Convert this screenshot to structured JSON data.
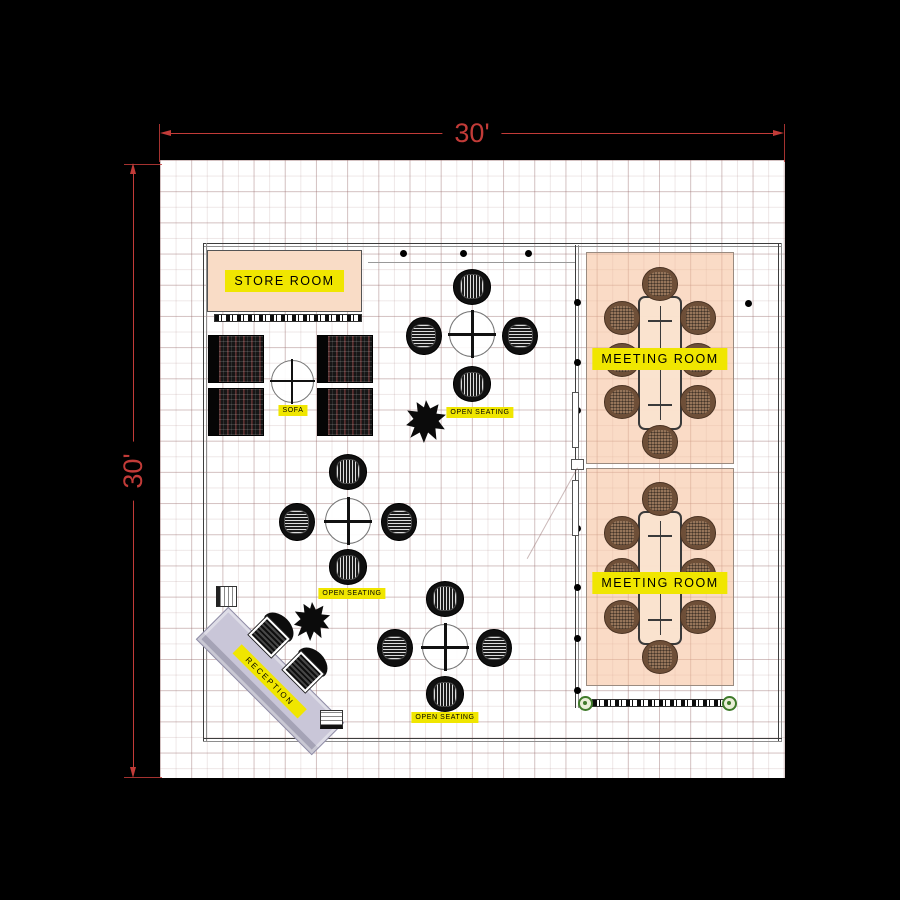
{
  "scene": {
    "type": "office floor plan",
    "background": "#000000"
  },
  "dimensions": {
    "top": {
      "label": "30'"
    },
    "left": {
      "label": "30'"
    }
  },
  "rooms": {
    "store_room": {
      "label": "STORE ROOM"
    },
    "meeting_room_1": {
      "label": "MEETING ROOM"
    },
    "meeting_room_2": {
      "label": "MEETING ROOM"
    }
  },
  "areas": {
    "sofa": {
      "label": "SOFA"
    },
    "open_seating_1": {
      "label": "OPEN SEATING"
    },
    "open_seating_2": {
      "label": "OPEN SEATING"
    },
    "open_seating_3": {
      "label": "OPEN SEATING"
    },
    "reception": {
      "label": "RECEPTION"
    }
  },
  "colors": {
    "dimension_red": "#c23b38",
    "label_yellow": "#f0e600",
    "floor_white": "#ffffff",
    "room_peach": "#f6be98",
    "meeting_chair_brown": "#96755a"
  }
}
